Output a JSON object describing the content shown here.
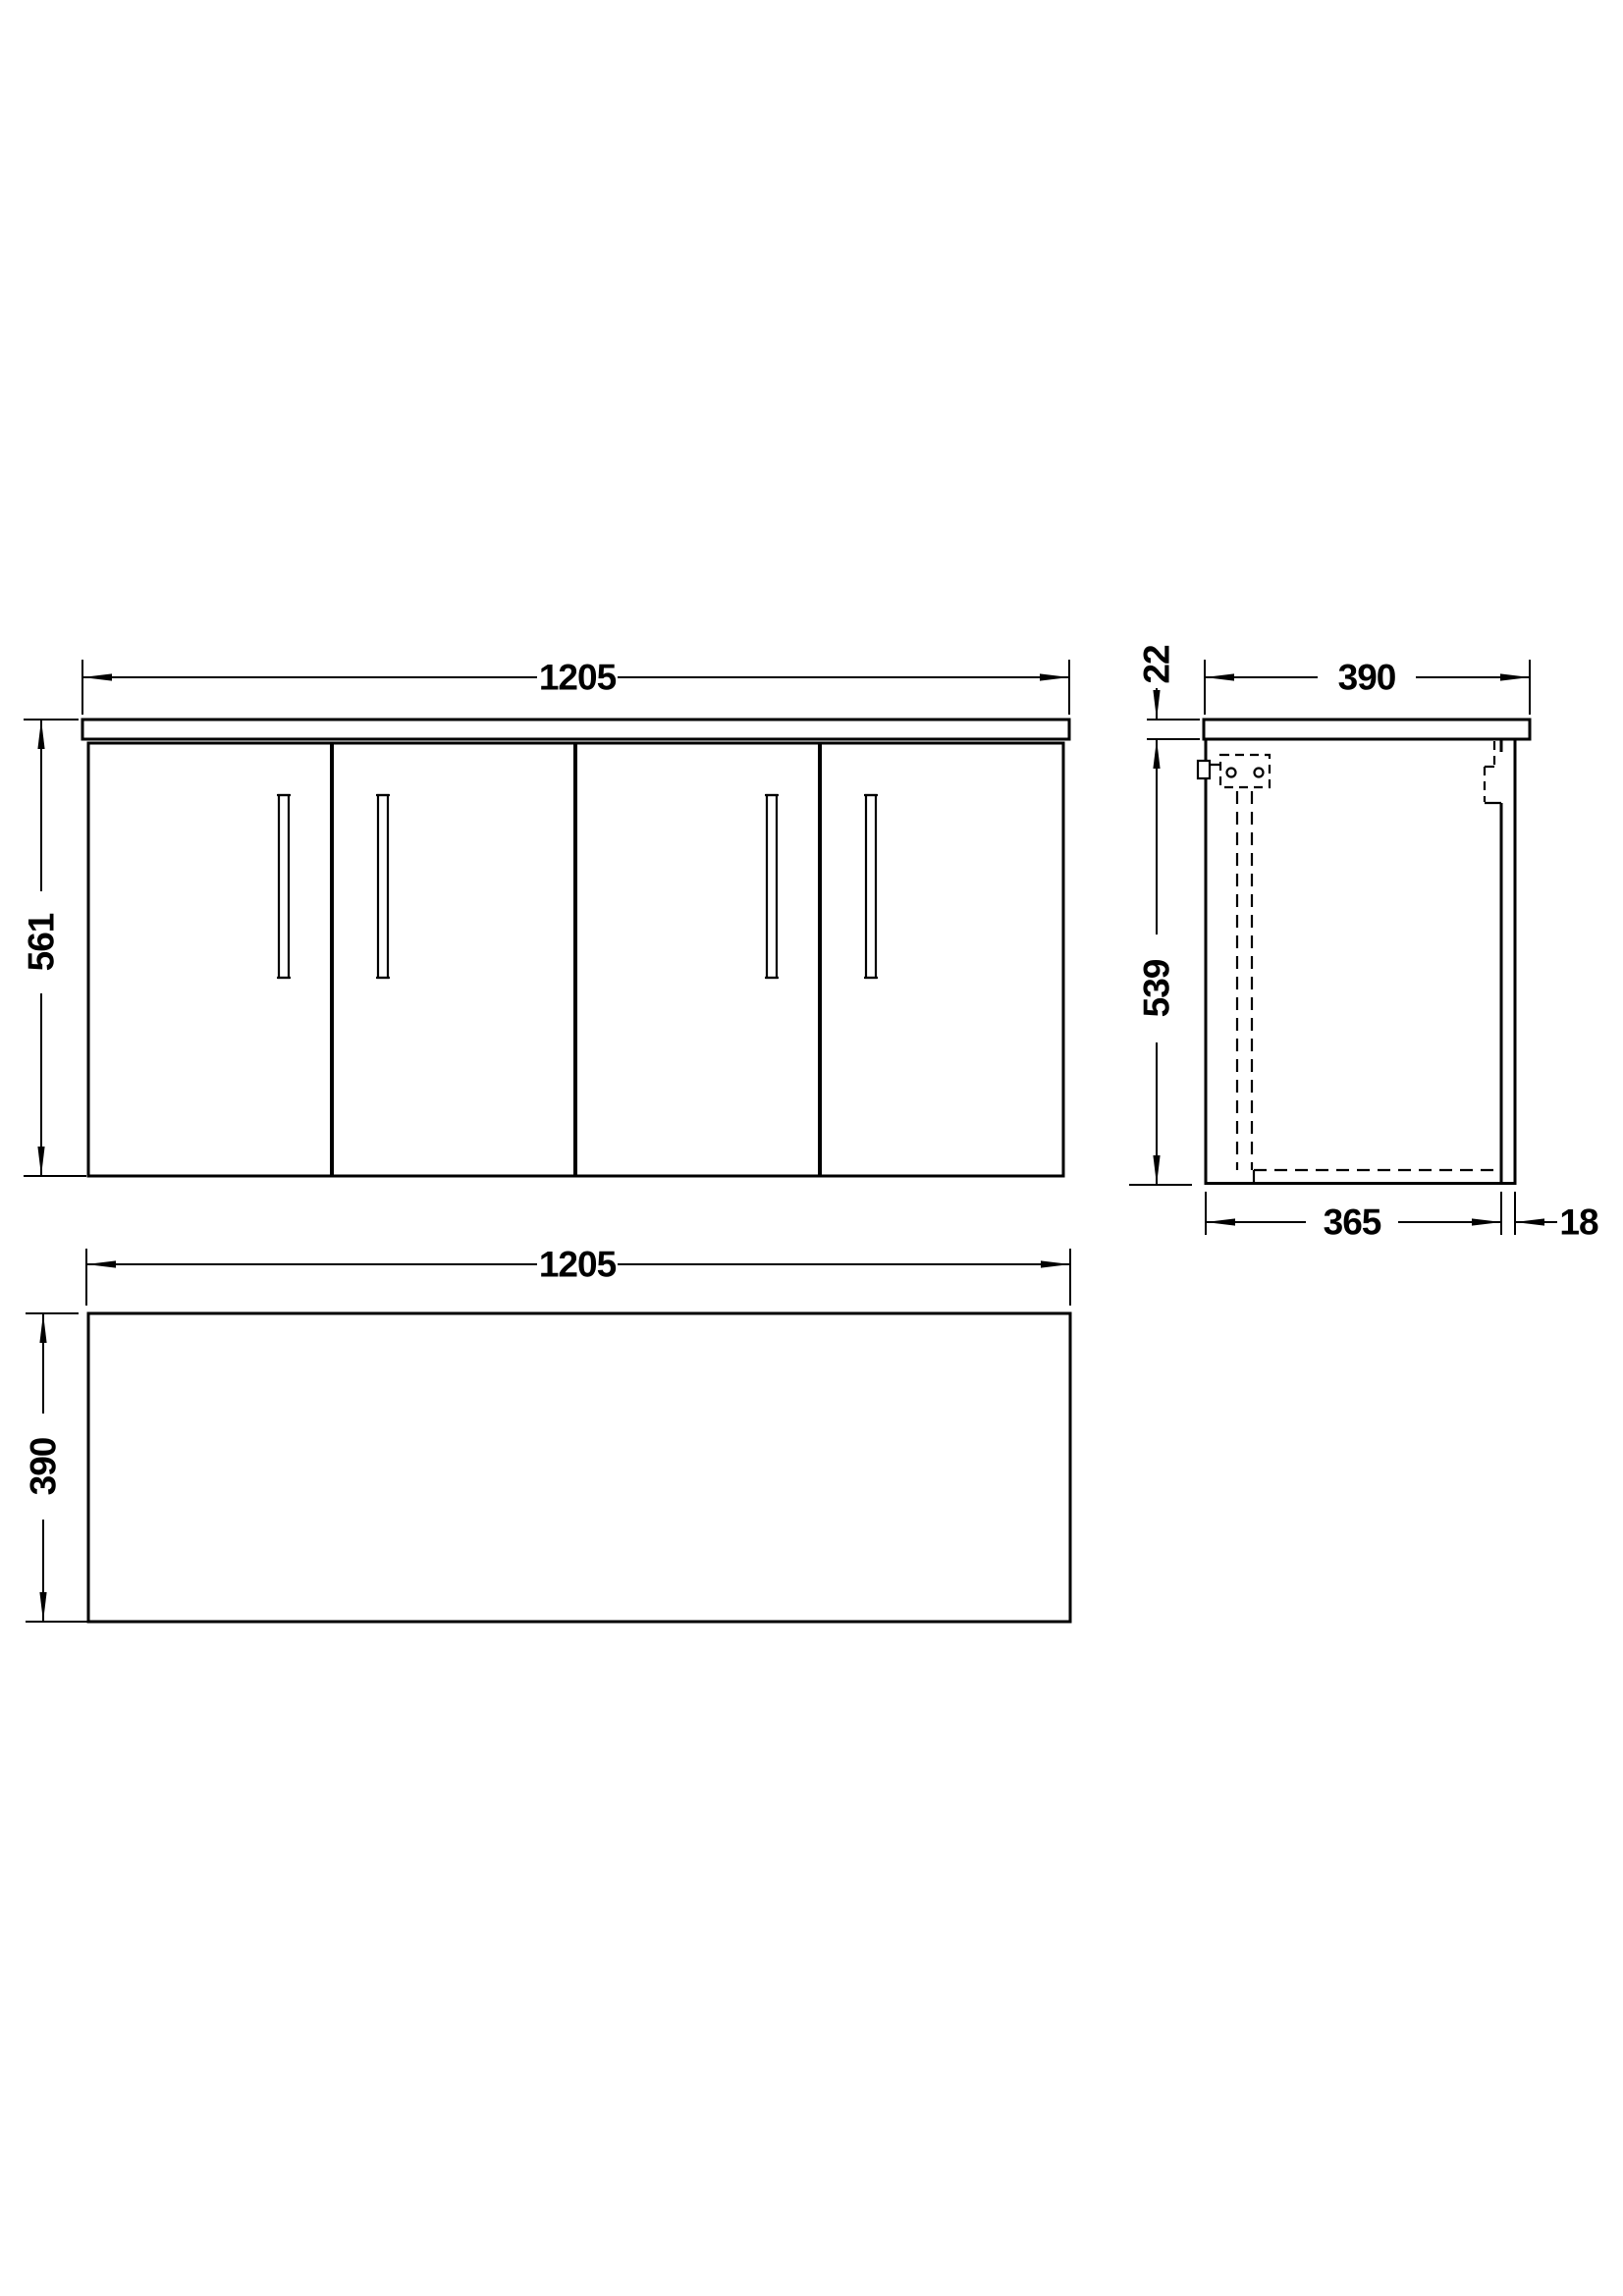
{
  "colors": {
    "line": "#000000",
    "background": "#ffffff"
  },
  "views": {
    "front": {
      "width": "1205",
      "height": "561"
    },
    "side": {
      "depth": "390",
      "counter_thickness": "22",
      "height": "539",
      "internal_depth": "365",
      "back_panel": "18"
    },
    "plan": {
      "width": "1205",
      "depth": "390"
    }
  }
}
